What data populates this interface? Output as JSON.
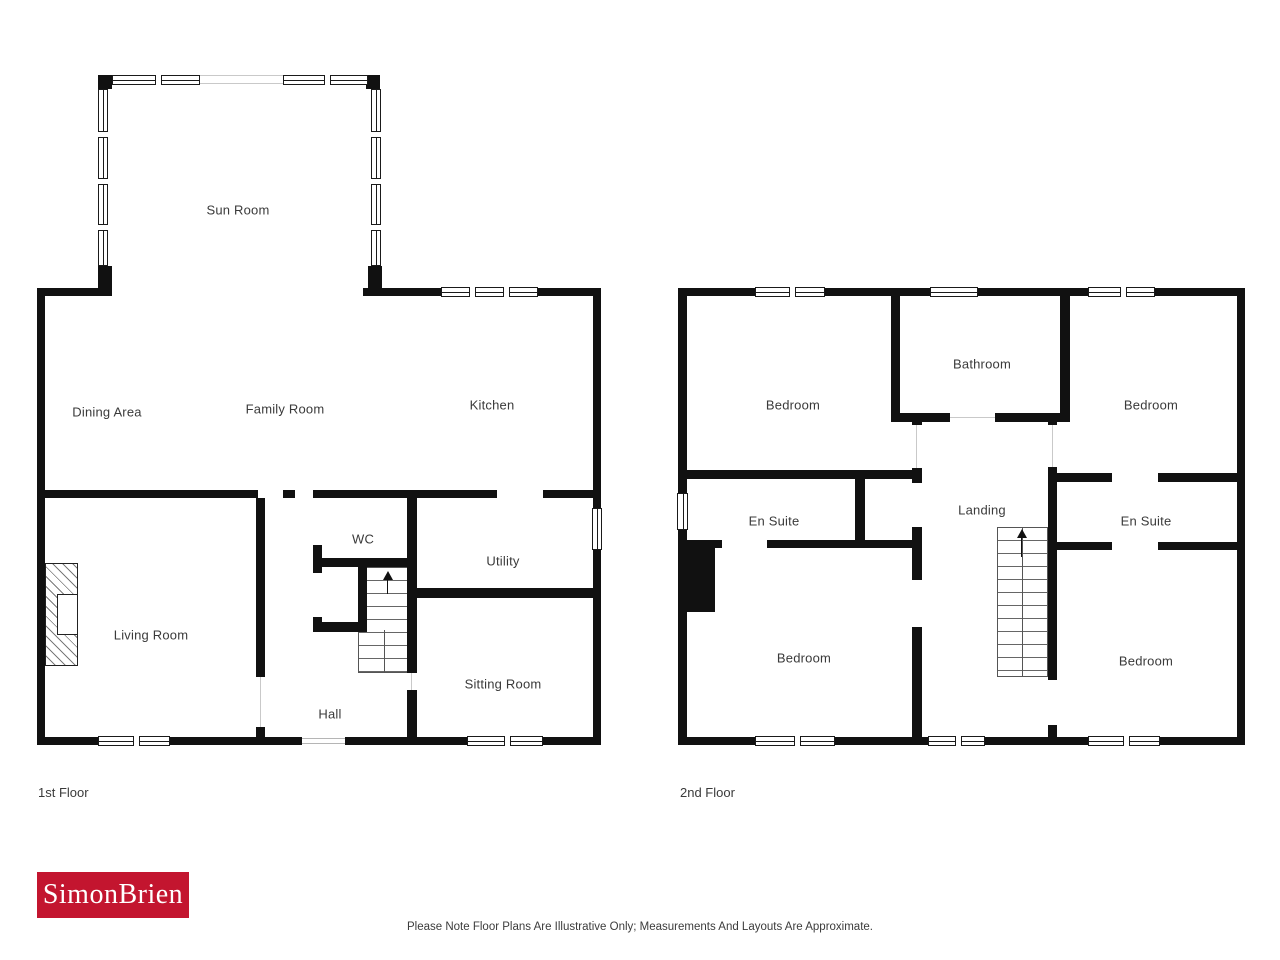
{
  "page": {
    "background": "#ffffff"
  },
  "colors": {
    "wall": "#111111",
    "label_text": "#3a3a3a",
    "logo_background": "#c3152f",
    "logo_text": "#ffffff"
  },
  "floor1": {
    "caption": "1st Floor",
    "rooms": [
      {
        "label": "Sun Room"
      },
      {
        "label": "Dining Area"
      },
      {
        "label": "Family Room"
      },
      {
        "label": "Kitchen"
      },
      {
        "label": "Living Room"
      },
      {
        "label": "WC"
      },
      {
        "label": "Utility"
      },
      {
        "label": "Sitting Room"
      },
      {
        "label": "Hall"
      }
    ]
  },
  "floor2": {
    "caption": "2nd Floor",
    "rooms": [
      {
        "label": "Bedroom"
      },
      {
        "label": "Bathroom"
      },
      {
        "label": "Bedroom"
      },
      {
        "label": "En Suite"
      },
      {
        "label": "Landing"
      },
      {
        "label": "En Suite"
      },
      {
        "label": "Bedroom"
      },
      {
        "label": "Bedroom"
      }
    ]
  },
  "icons": {
    "stairs_direction": "up-arrow"
  },
  "logo": {
    "text": "SimonBrien"
  },
  "footer": {
    "disclaimer": "Please Note Floor Plans Are Illustrative Only; Measurements And Layouts Are Approximate."
  }
}
